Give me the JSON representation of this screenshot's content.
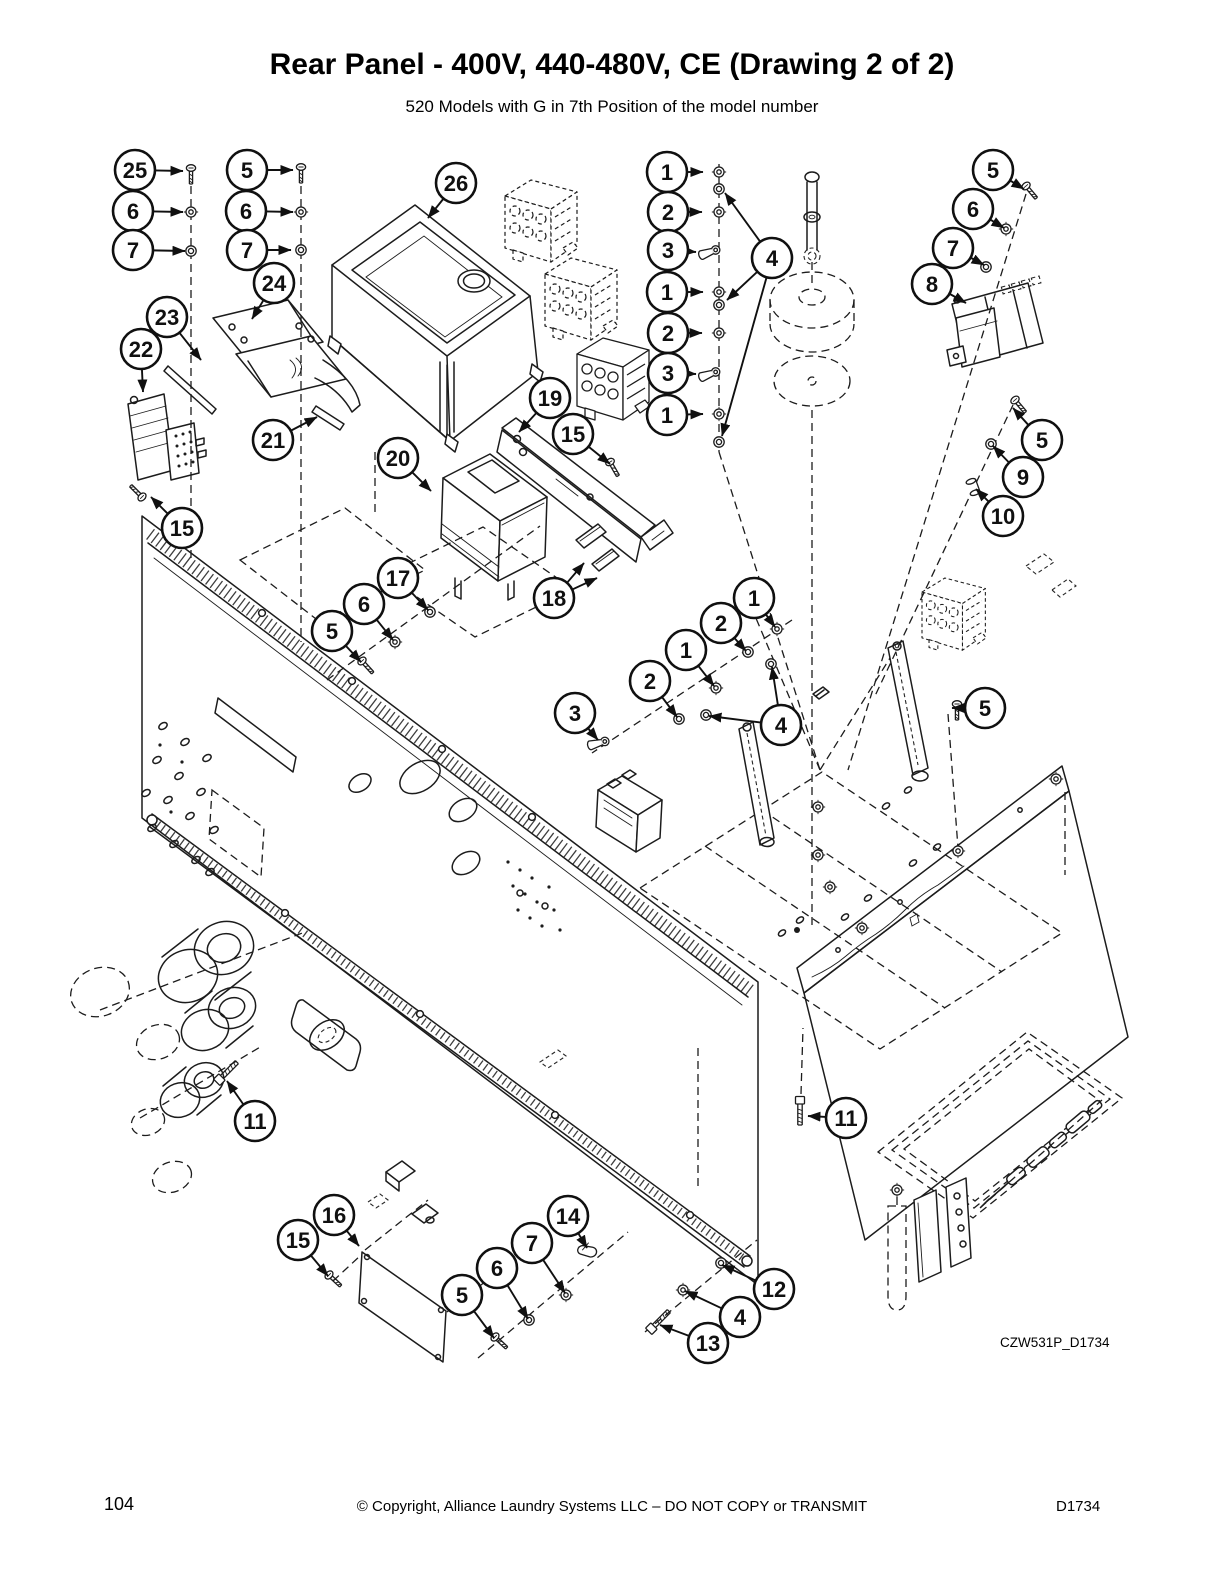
{
  "header": {
    "title": "Rear Panel - 400V, 440-480V, CE (Drawing 2 of 2)",
    "subtitle": "520 Models with G in 7th Position of the model number"
  },
  "figure": {
    "drawing_code": "CZW531P_D1734"
  },
  "footer": {
    "page_number": "104",
    "copyright": "© Copyright, Alliance Laundry Systems LLC – DO NOT COPY or TRANSMIT",
    "doc_code": "D1734"
  },
  "diagram": {
    "balloon_radius": 20,
    "callouts": [
      {
        "label": "25",
        "x": 135,
        "y": 170,
        "targets": [
          [
            183,
            171
          ]
        ]
      },
      {
        "label": "6",
        "x": 133,
        "y": 211,
        "targets": [
          [
            183,
            212
          ]
        ]
      },
      {
        "label": "7",
        "x": 133,
        "y": 250,
        "targets": [
          [
            185,
            251
          ]
        ]
      },
      {
        "label": "5",
        "x": 247,
        "y": 170,
        "targets": [
          [
            293,
            170
          ]
        ]
      },
      {
        "label": "6",
        "x": 246,
        "y": 211,
        "targets": [
          [
            293,
            212
          ]
        ]
      },
      {
        "label": "7",
        "x": 247,
        "y": 250,
        "targets": [
          [
            291,
            250
          ]
        ]
      },
      {
        "label": "24",
        "x": 274,
        "y": 283,
        "targets": [
          [
            252,
            319
          ]
        ]
      },
      {
        "label": "23",
        "x": 167,
        "y": 317,
        "targets": [
          [
            201,
            360
          ]
        ]
      },
      {
        "label": "22",
        "x": 141,
        "y": 349,
        "targets": [
          [
            143,
            392
          ]
        ]
      },
      {
        "label": "26",
        "x": 456,
        "y": 183,
        "targets": [
          [
            428,
            218
          ]
        ]
      },
      {
        "label": "21",
        "x": 273,
        "y": 440,
        "targets": [
          [
            317,
            417
          ]
        ]
      },
      {
        "label": "15",
        "x": 182,
        "y": 528,
        "targets": [
          [
            151,
            497
          ]
        ]
      },
      {
        "label": "19",
        "x": 550,
        "y": 398,
        "targets": [
          [
            519,
            432
          ]
        ]
      },
      {
        "label": "15",
        "x": 573,
        "y": 434,
        "targets": [
          [
            610,
            464
          ]
        ]
      },
      {
        "label": "20",
        "x": 398,
        "y": 458,
        "targets": [
          [
            431,
            491
          ]
        ]
      },
      {
        "label": "17",
        "x": 398,
        "y": 578,
        "targets": [
          [
            428,
            610
          ]
        ]
      },
      {
        "label": "6",
        "x": 364,
        "y": 604,
        "targets": [
          [
            393,
            640
          ]
        ]
      },
      {
        "label": "5",
        "x": 332,
        "y": 631,
        "targets": [
          [
            361,
            662
          ]
        ]
      },
      {
        "label": "18",
        "x": 554,
        "y": 598,
        "targets": [
          [
            584,
            563
          ],
          [
            597,
            578
          ]
        ]
      },
      {
        "label": "1",
        "x": 667,
        "y": 172,
        "targets": [
          [
            703,
            172
          ]
        ]
      },
      {
        "label": "2",
        "x": 668,
        "y": 212,
        "targets": [
          [
            702,
            212
          ]
        ]
      },
      {
        "label": "3",
        "x": 668,
        "y": 250,
        "targets": [
          [
            696,
            252
          ]
        ]
      },
      {
        "label": "1",
        "x": 667,
        "y": 292,
        "targets": [
          [
            703,
            292
          ]
        ]
      },
      {
        "label": "2",
        "x": 668,
        "y": 333,
        "targets": [
          [
            702,
            333
          ]
        ]
      },
      {
        "label": "3",
        "x": 668,
        "y": 373,
        "targets": [
          [
            696,
            374
          ]
        ]
      },
      {
        "label": "1",
        "x": 667,
        "y": 415,
        "targets": [
          [
            703,
            414
          ]
        ]
      },
      {
        "label": "4",
        "x": 772,
        "y": 258,
        "targets": [
          [
            725,
            193
          ],
          [
            727,
            300
          ],
          [
            722,
            436
          ]
        ]
      },
      {
        "label": "5",
        "x": 993,
        "y": 170,
        "targets": [
          [
            1024,
            189
          ]
        ]
      },
      {
        "label": "6",
        "x": 973,
        "y": 209,
        "targets": [
          [
            1004,
            228
          ]
        ]
      },
      {
        "label": "7",
        "x": 953,
        "y": 248,
        "targets": [
          [
            984,
            265
          ]
        ]
      },
      {
        "label": "8",
        "x": 932,
        "y": 284,
        "targets": [
          [
            966,
            303
          ]
        ]
      },
      {
        "label": "5",
        "x": 1042,
        "y": 440,
        "targets": [
          [
            1013,
            408
          ]
        ]
      },
      {
        "label": "9",
        "x": 1023,
        "y": 477,
        "targets": [
          [
            993,
            446
          ]
        ]
      },
      {
        "label": "10",
        "x": 1003,
        "y": 516,
        "targets": [
          [
            976,
            489
          ]
        ]
      },
      {
        "label": "1",
        "x": 754,
        "y": 598,
        "targets": [
          [
            775,
            627
          ]
        ]
      },
      {
        "label": "2",
        "x": 721,
        "y": 623,
        "targets": [
          [
            746,
            651
          ]
        ]
      },
      {
        "label": "1",
        "x": 686,
        "y": 650,
        "targets": [
          [
            714,
            686
          ]
        ]
      },
      {
        "label": "2",
        "x": 650,
        "y": 681,
        "targets": [
          [
            677,
            717
          ]
        ]
      },
      {
        "label": "3",
        "x": 575,
        "y": 713,
        "targets": [
          [
            598,
            740
          ]
        ]
      },
      {
        "label": "4",
        "x": 781,
        "y": 725,
        "targets": [
          [
            772,
            667
          ],
          [
            709,
            716
          ]
        ]
      },
      {
        "label": "5",
        "x": 985,
        "y": 708,
        "targets": [
          [
            952,
            708
          ]
        ]
      },
      {
        "label": "11",
        "x": 255,
        "y": 1121,
        "targets": [
          [
            227,
            1081
          ]
        ]
      },
      {
        "label": "11",
        "x": 846,
        "y": 1118,
        "targets": [
          [
            808,
            1116
          ]
        ]
      },
      {
        "label": "15",
        "x": 298,
        "y": 1240,
        "targets": [
          [
            328,
            1276
          ]
        ]
      },
      {
        "label": "16",
        "x": 334,
        "y": 1215,
        "targets": [
          [
            359,
            1246
          ]
        ]
      },
      {
        "label": "5",
        "x": 462,
        "y": 1295,
        "targets": [
          [
            494,
            1338
          ]
        ]
      },
      {
        "label": "6",
        "x": 497,
        "y": 1268,
        "targets": [
          [
            528,
            1319
          ]
        ]
      },
      {
        "label": "7",
        "x": 532,
        "y": 1243,
        "targets": [
          [
            565,
            1293
          ]
        ]
      },
      {
        "label": "14",
        "x": 568,
        "y": 1216,
        "targets": [
          [
            587,
            1248
          ]
        ]
      },
      {
        "label": "12",
        "x": 774,
        "y": 1289,
        "targets": [
          [
            722,
            1265
          ]
        ]
      },
      {
        "label": "4",
        "x": 740,
        "y": 1317,
        "targets": [
          [
            685,
            1291
          ]
        ]
      },
      {
        "label": "13",
        "x": 708,
        "y": 1343,
        "targets": [
          [
            660,
            1325
          ]
        ]
      }
    ]
  }
}
